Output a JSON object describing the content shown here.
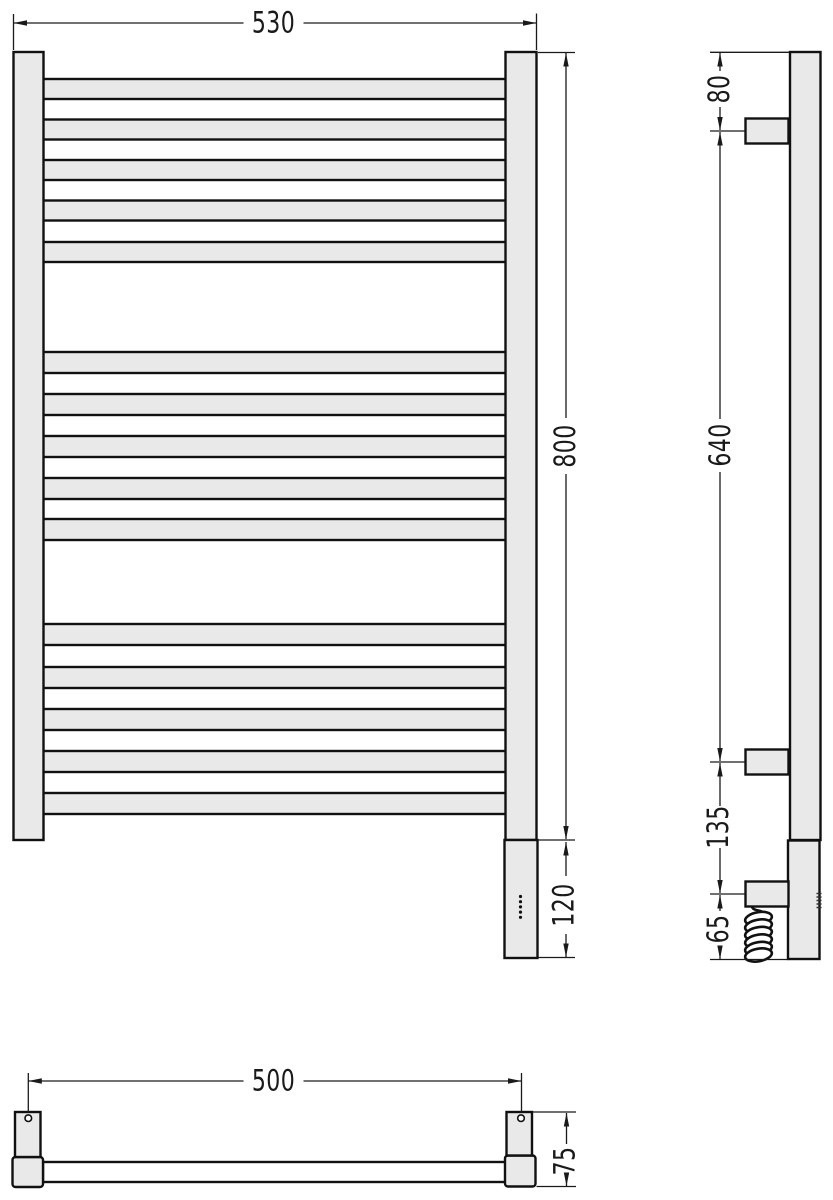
{
  "front_view": {
    "width_label": "530",
    "height_label": "800",
    "heating_element_label": "120"
  },
  "side_view": {
    "top_bracket_offset_label": "80",
    "bracket_span_label": "640",
    "lower_bracket_gap_label": "135",
    "bottom_offset_label": "65"
  },
  "plan_view": {
    "mount_spacing_label": "500",
    "depth_label": "75"
  },
  "structure": {
    "rung_count": 15,
    "rung_groups": 3,
    "rungs_per_group": 5,
    "wall_brackets": 3,
    "indicator_dots": 5
  },
  "colors": {
    "background": "#ffffff",
    "object_fill": "#e9e9e9",
    "line": "#1a1a1a"
  }
}
